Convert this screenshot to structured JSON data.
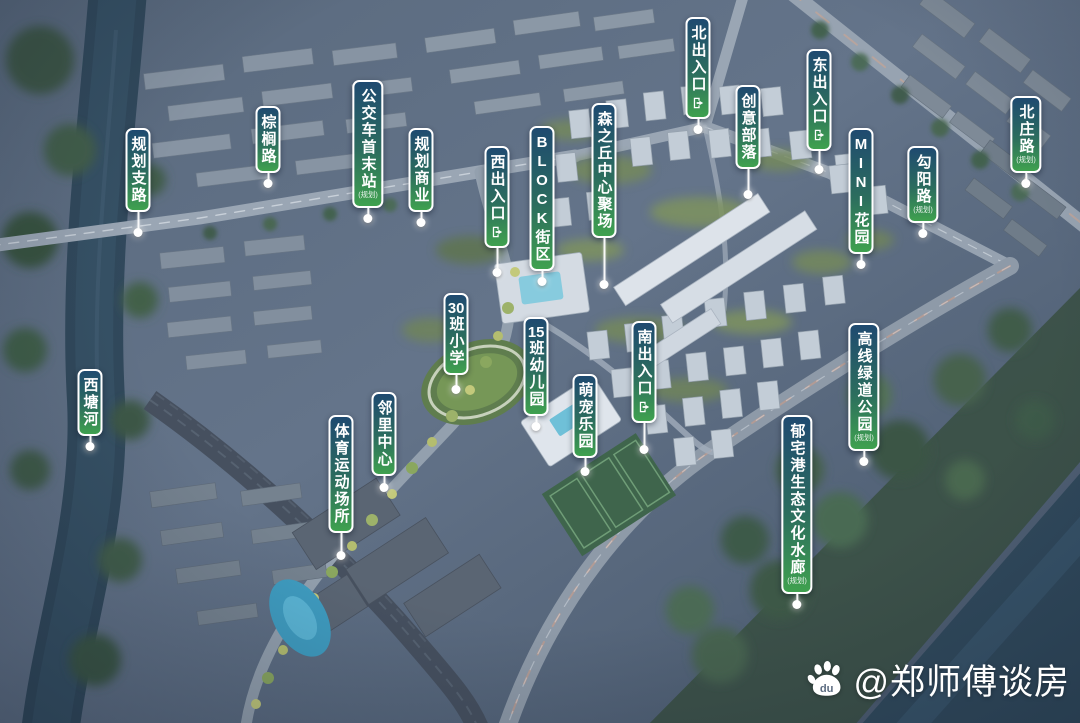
{
  "labels": [
    {
      "id": "guihua-zhilu",
      "text": "规划支路",
      "x": 138,
      "pill_top": 128,
      "dot_y": 233
    },
    {
      "id": "zonglv-road",
      "text": "棕榈路",
      "x": 268,
      "pill_top": 106,
      "dot_y": 181
    },
    {
      "id": "bus-terminus",
      "text": "公交车首末站",
      "note": "(规划)",
      "x": 368,
      "pill_top": 80,
      "dot_y": 212
    },
    {
      "id": "guihua-shangye",
      "text": "规划商业",
      "x": 421,
      "pill_top": 128,
      "dot_y": 219
    },
    {
      "id": "west-entrance",
      "text": "西出入口",
      "icon": "exit-icon",
      "x": 497,
      "pill_top": 146,
      "dot_y": 273
    },
    {
      "id": "block-street",
      "text": "BLOCK街区",
      "x": 542,
      "pill_top": 126,
      "dot_y": 272
    },
    {
      "id": "forest-hill-plaza",
      "text": "森之丘中心聚场",
      "x": 604,
      "pill_top": 103,
      "dot_y": 285
    },
    {
      "id": "north-entrance",
      "text": "北出入口",
      "icon": "exit-icon",
      "x": 698,
      "pill_top": 17,
      "dot_y": 130
    },
    {
      "id": "creative-tribe",
      "text": "创意部落",
      "x": 748,
      "pill_top": 85,
      "dot_y": 195
    },
    {
      "id": "east-entrance",
      "text": "东出入口",
      "icon": "exit-icon",
      "x": 819,
      "pill_top": 49,
      "dot_y": 170
    },
    {
      "id": "mini-garden",
      "text": "MINI花园",
      "x": 861,
      "pill_top": 128,
      "dot_y": 255
    },
    {
      "id": "gouyang-road",
      "text": "勾阳路",
      "note": "(规划)",
      "x": 923,
      "pill_top": 146,
      "dot_y": 228
    },
    {
      "id": "beizhuang-road",
      "text": "北庄路",
      "note": "(规划)",
      "x": 1026,
      "pill_top": 96,
      "dot_y": 180
    },
    {
      "id": "xitang-river",
      "text": "西塘河",
      "x": 90,
      "pill_top": 369,
      "dot_y": 447
    },
    {
      "id": "primary-school",
      "text": "30班小学",
      "x": 456,
      "pill_top": 293,
      "dot_y": 390
    },
    {
      "id": "kindergarten",
      "text": "15班幼儿园",
      "x": 536,
      "pill_top": 317,
      "dot_y": 427
    },
    {
      "id": "pet-park",
      "text": "萌宠乐园",
      "x": 585,
      "pill_top": 374,
      "dot_y": 472
    },
    {
      "id": "south-entrance",
      "text": "南出入口",
      "icon": "exit-icon",
      "x": 644,
      "pill_top": 321,
      "dot_y": 450
    },
    {
      "id": "neighborhood-center",
      "text": "邻里中心",
      "x": 384,
      "pill_top": 392,
      "dot_y": 488
    },
    {
      "id": "sports-area",
      "text": "体育运动场所",
      "x": 341,
      "pill_top": 415,
      "dot_y": 556
    },
    {
      "id": "highline-greenway-park",
      "text": "高线绿道公园",
      "note": "(规划)",
      "x": 864,
      "pill_top": 323,
      "dot_y": 457
    },
    {
      "id": "yuzhai-eco-corridor",
      "text": "郁宅港生态文化水廊",
      "note": "(规划)",
      "x": 797,
      "pill_top": 415,
      "dot_y": 600
    }
  ],
  "watermark": {
    "icon": "baidu-paw-icon",
    "text": "@郑师傅谈房"
  },
  "colors": {
    "pill_top": "#1f4a70",
    "pill_bottom": "#3fa14f",
    "pill_border": "#ffffff",
    "label_text": "#ffffff",
    "leader": "#ffffff",
    "watermark_text": "#ffffff"
  }
}
